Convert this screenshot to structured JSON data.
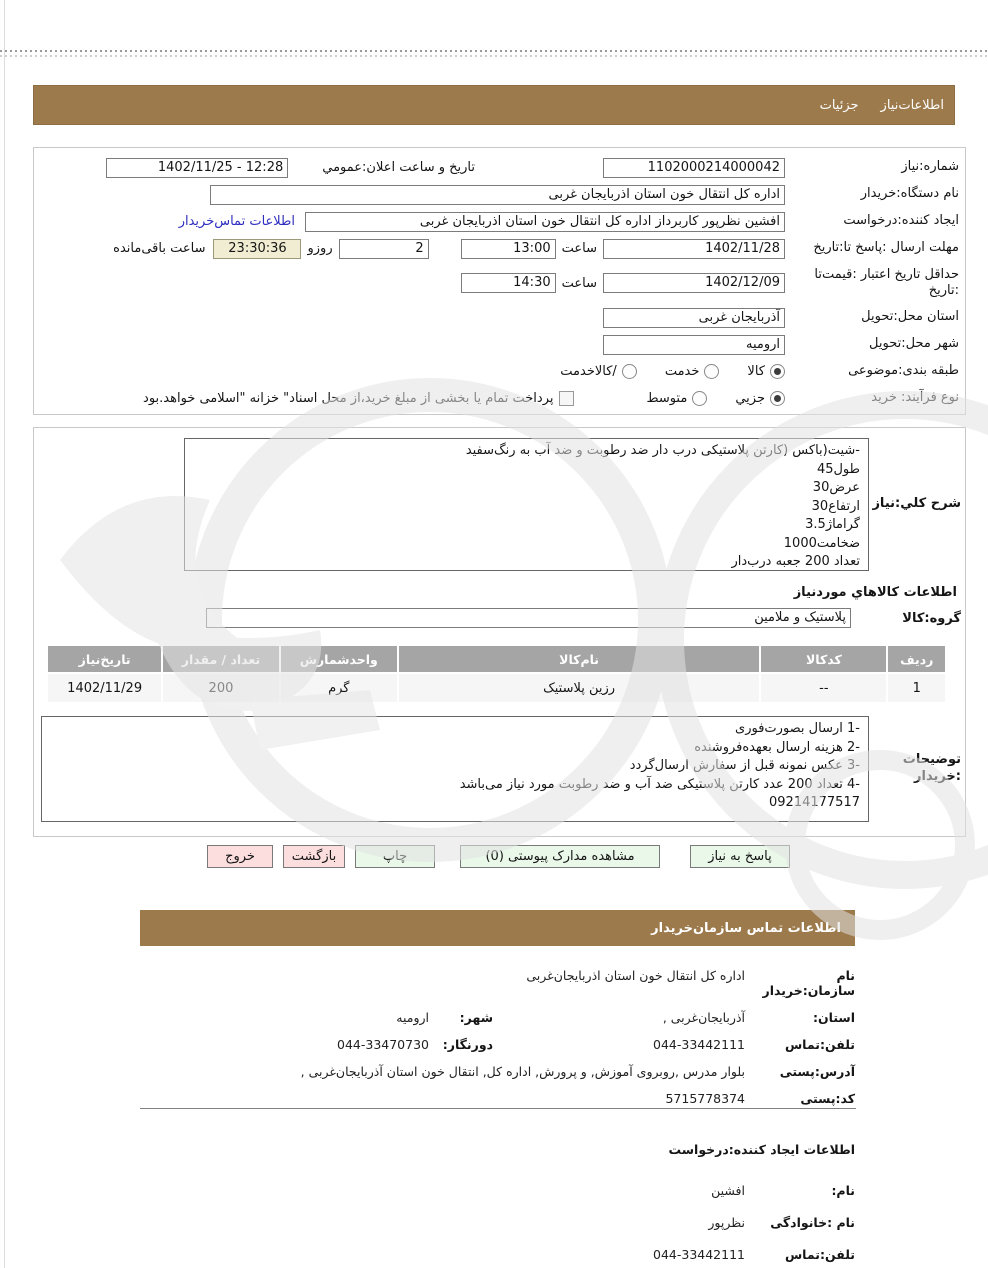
{
  "colors": {
    "brand_brown": "#9c7a4c",
    "countdown_bg": "#f1edd2",
    "button_green": "#e9f8e9",
    "button_pink": "#fcdede",
    "link_blue": "#2e2ec0",
    "table_header_gray": "#a5a5a5"
  },
  "titlebar": {
    "item_left": "جزئیات",
    "item_right": "اطلاعات‌نیاز"
  },
  "form": {
    "need_number_label": "شماره:نیاز",
    "need_number": "1102000214000042",
    "announce_label": "تاریخ و ساعت اعلان:عمومي",
    "announce_value": "12:28 - 1402/11/25",
    "device_label": "نام دستگاه:خریدار",
    "device_value": "اداره کل انتقال خون استان اذربایجان غربی",
    "creator_label": "ایجاد کننده:درخواست",
    "creator_value": "افشین نظرپور کاربرداز اداره کل انتقال خون استان اذربایجان غربی",
    "creator_link": "اطلاعات تماس‌خریدار",
    "deadline_label": "مهلت ارسال :پاسخ تا:تاریخ",
    "deadline_date": "1402/11/28",
    "hour_label": "ساعت",
    "deadline_hour": "13:00",
    "deadline_days": "2",
    "days_label": "روزو",
    "countdown": "23:30:36",
    "countdown_label": "ساعت باقی‌مانده",
    "validity_label": "حداقل تاریخ اعتبار :قیمت‌تا :تاریخ",
    "validity_date": "1402/12/09",
    "validity_hour": "14:30",
    "province_label": "استان محل:تحویل",
    "province_value": "آذربایجان غربی",
    "city_label": "شهر محل:تحویل",
    "city_value": "ارومیه",
    "classification_label": "طبقه بندی:موضوعی",
    "class_opt1": "کالا",
    "class_opt2": "خدمت",
    "class_opt3": "/کالاخدمت",
    "class_selected": "کالا",
    "process_label": "نوع فرآیند: خرید",
    "proc_opt1": "جزيي",
    "proc_opt2": "متوسط",
    "proc_selected": "جزيي",
    "treasury_checkbox_label": "پرداخت تمام یا بخشی از مبلغ خرید،از محل اسناد\" خزانه \"اسلامی خواهد.بود"
  },
  "need": {
    "desc_label": "شرح کلي:نیاز",
    "desc_lines": [
      "-شیت(باکس (کارتن پلاستیکی درب دار ضد رطوبت و ضد آب به رنگ‌سفید",
      "طول45",
      "عرض30",
      "ارتفاع30",
      "گراماژ3.5",
      "ضخامت1000",
      "تعداد 200 جعبه درب‌دار"
    ]
  },
  "goods": {
    "section_heading": "اطلاعات کالاهاي موردنیاز",
    "group_label": "گروه:کالا",
    "group_value": "پلاستیک و ملامین",
    "headers": [
      "ردیف",
      "کدکالا",
      "نام‌کالا",
      "واحدشمارش",
      "تعداد / مقدار",
      "تاریخ‌نیاز"
    ],
    "row": [
      "1",
      "--",
      "رزین پلاستیک",
      "گرم",
      "200",
      "1402/11/29"
    ]
  },
  "notes": {
    "label": "توضیحات :خریدار",
    "lines": [
      "-1 ارسال بصورت‌فوری",
      "-2 هزینه ارسال بعهده‌فروشنده",
      "-3 عکس نمونه قبل از سفارش ارسال‌گردد",
      "-4 تعداد 200 عدد کارتن پلاستیکی ضد آب و ضد رطوبت مورد نیاز می‌باشد",
      "09214177517"
    ]
  },
  "buttons": {
    "reply": "پاسخ به نیاز",
    "view_docs": "مشاهده مدارک پیوستی (0)",
    "print": "چاپ",
    "back": "بازگشت",
    "exit": "خروج"
  },
  "org_contact": {
    "bar_title": "اطلاعات  تماس سازمان‌خریدار",
    "org_label": "نام سازمان:خریدار",
    "org_value": "اداره کل انتقال خون استان اذربایجان‌غربی",
    "province_label": "استان:",
    "province_value": "آذربایجان‌غربی ,",
    "city_label": "شهر:",
    "city_value": "ارومیه",
    "phone_label": "تلفن:تماس",
    "phone_value": "044-33442111",
    "fax_label": "دورنگار:",
    "fax_value": "044-33470730",
    "address_label": "آدرس:پستی",
    "address_value": "بلوار مدرس ,روبروی آموزش, و پرورش, اداره کل, انتقال خون استان آذربایجان‌غربی ,",
    "postal_label": "کد:پستی",
    "postal_value": "5715778374"
  },
  "creator_info": {
    "heading": "اطلاعات ایجاد کننده:درخواست",
    "name_label": "نام:",
    "name_value": "افشین",
    "family_label": "نام :خانوادگی",
    "family_value": "نظرپور",
    "phone_label": "تلفن:تماس",
    "phone_value": "044-33442111"
  }
}
